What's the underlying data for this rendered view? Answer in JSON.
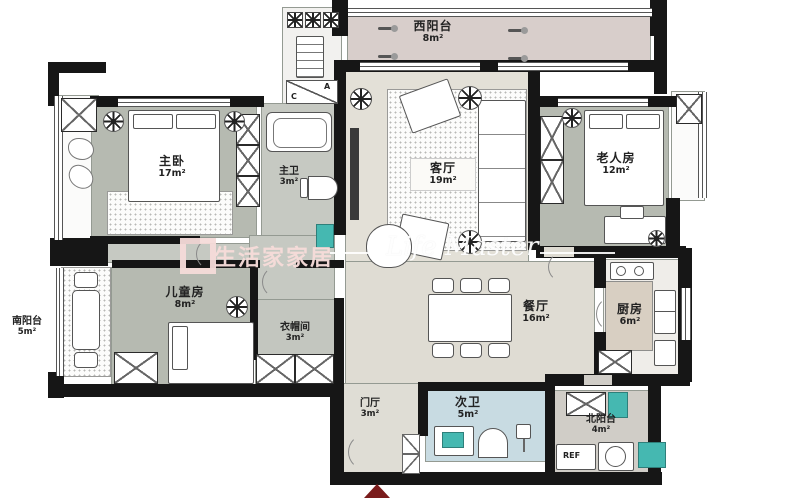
{
  "title": "apartment-floor-plan",
  "rooms": [
    {
      "id": "west-balcony",
      "name": "西阳台",
      "area": "8m²"
    },
    {
      "id": "master-bedroom",
      "name": "主卧",
      "area": "17m²"
    },
    {
      "id": "master-bath",
      "name": "主卫",
      "area": "3m²"
    },
    {
      "id": "living-room",
      "name": "客厅",
      "area": "19m²"
    },
    {
      "id": "elder-room",
      "name": "老人房",
      "area": "12m²"
    },
    {
      "id": "children-room",
      "name": "儿童房",
      "area": "8m²"
    },
    {
      "id": "cloak-room",
      "name": "衣帽间",
      "area": "3m²"
    },
    {
      "id": "south-balcony",
      "name": "南阳台",
      "area": "5m²"
    },
    {
      "id": "dining-room",
      "name": "餐厅",
      "area": "16m²"
    },
    {
      "id": "kitchen",
      "name": "厨房",
      "area": "6m²"
    },
    {
      "id": "entry-hall",
      "name": "门厅",
      "area": "3m²"
    },
    {
      "id": "second-bath",
      "name": "次卫",
      "area": "5m²"
    },
    {
      "id": "north-balcony",
      "name": "北阳台",
      "area": "4m²"
    }
  ],
  "equipment": {
    "c_label": "C",
    "a_label": "A",
    "ref_label": "REF"
  },
  "watermark": {
    "brand": "生活家家居",
    "script": "Life Master"
  },
  "colors": {
    "wall": "#161616",
    "sage_floor": "#b6bab1",
    "gray_floor": "#c6c9c2",
    "beige_floor": "#e3e0d7",
    "balcony_floor": "#d8cecb",
    "kitchen_floor": "#d8cfc2",
    "bath_blue": "#c8dbe2",
    "north_balcony": "#d0cdc7",
    "teal_fixture": "#45b8b1",
    "entrance_red": "#7a1c1c",
    "watermark_pink": "#f6dbd9"
  }
}
